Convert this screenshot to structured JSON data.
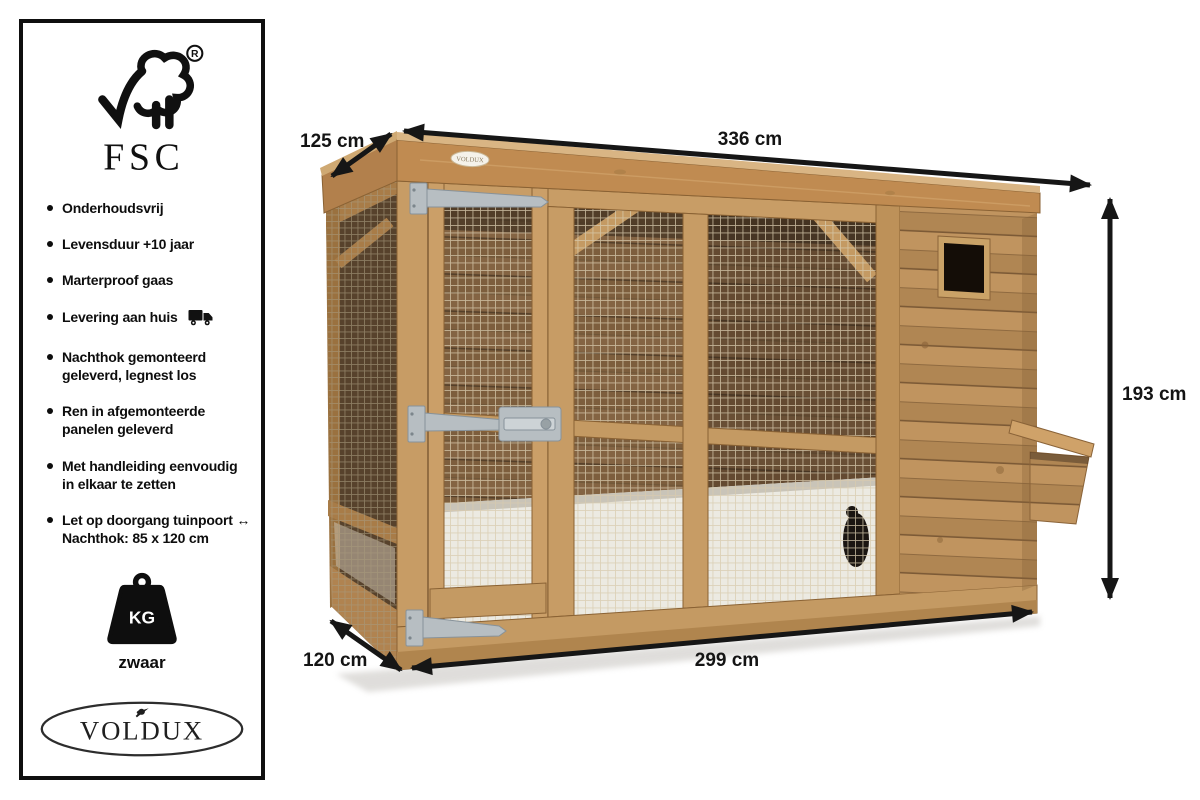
{
  "brand": {
    "fsc_label": "FSC",
    "fsc_registered": "R",
    "voldux": "VOLDUX",
    "fascia_plate": "VOLDUX"
  },
  "sidebar": {
    "features": [
      {
        "text": "Onderhoudsvrij"
      },
      {
        "text": "Levensduur +10 jaar"
      },
      {
        "text": "Marterproof gaas"
      },
      {
        "text": "Levering aan huis",
        "icon": "delivery-truck"
      },
      {
        "text": "Nachthok gemonteerd\ngeleverd, legnest los"
      },
      {
        "text": "Ren in afgemonteerde\npanelen geleverd"
      },
      {
        "text": "Met handleiding eenvoudig\nin elkaar te zetten"
      },
      {
        "text": "Let op doorgang tuinpoort ↔\nNachthok: 85 x 120 cm"
      }
    ],
    "weight": {
      "unit": "KG",
      "label": "zwaar"
    }
  },
  "dimensions": {
    "depth_top": "125 cm",
    "width_top": "336 cm",
    "height_right": "193 cm",
    "depth_bottom": "120 cm",
    "width_bottom": "299 cm",
    "nachthok_passage": "85 x 120 cm"
  },
  "colors": {
    "arrow_text": "#161616",
    "panel_border": "#0f0f0f",
    "wood_light": "#d9b584",
    "wood_frame": "#c49a63",
    "wood_mid": "#c0945f",
    "wood_dark": "#8a6338",
    "interior": "#7d5e3d",
    "floor": "#eceae2",
    "mesh": "#d9cbae",
    "metal": "#b7bec2",
    "window_opening": "#140d07"
  }
}
